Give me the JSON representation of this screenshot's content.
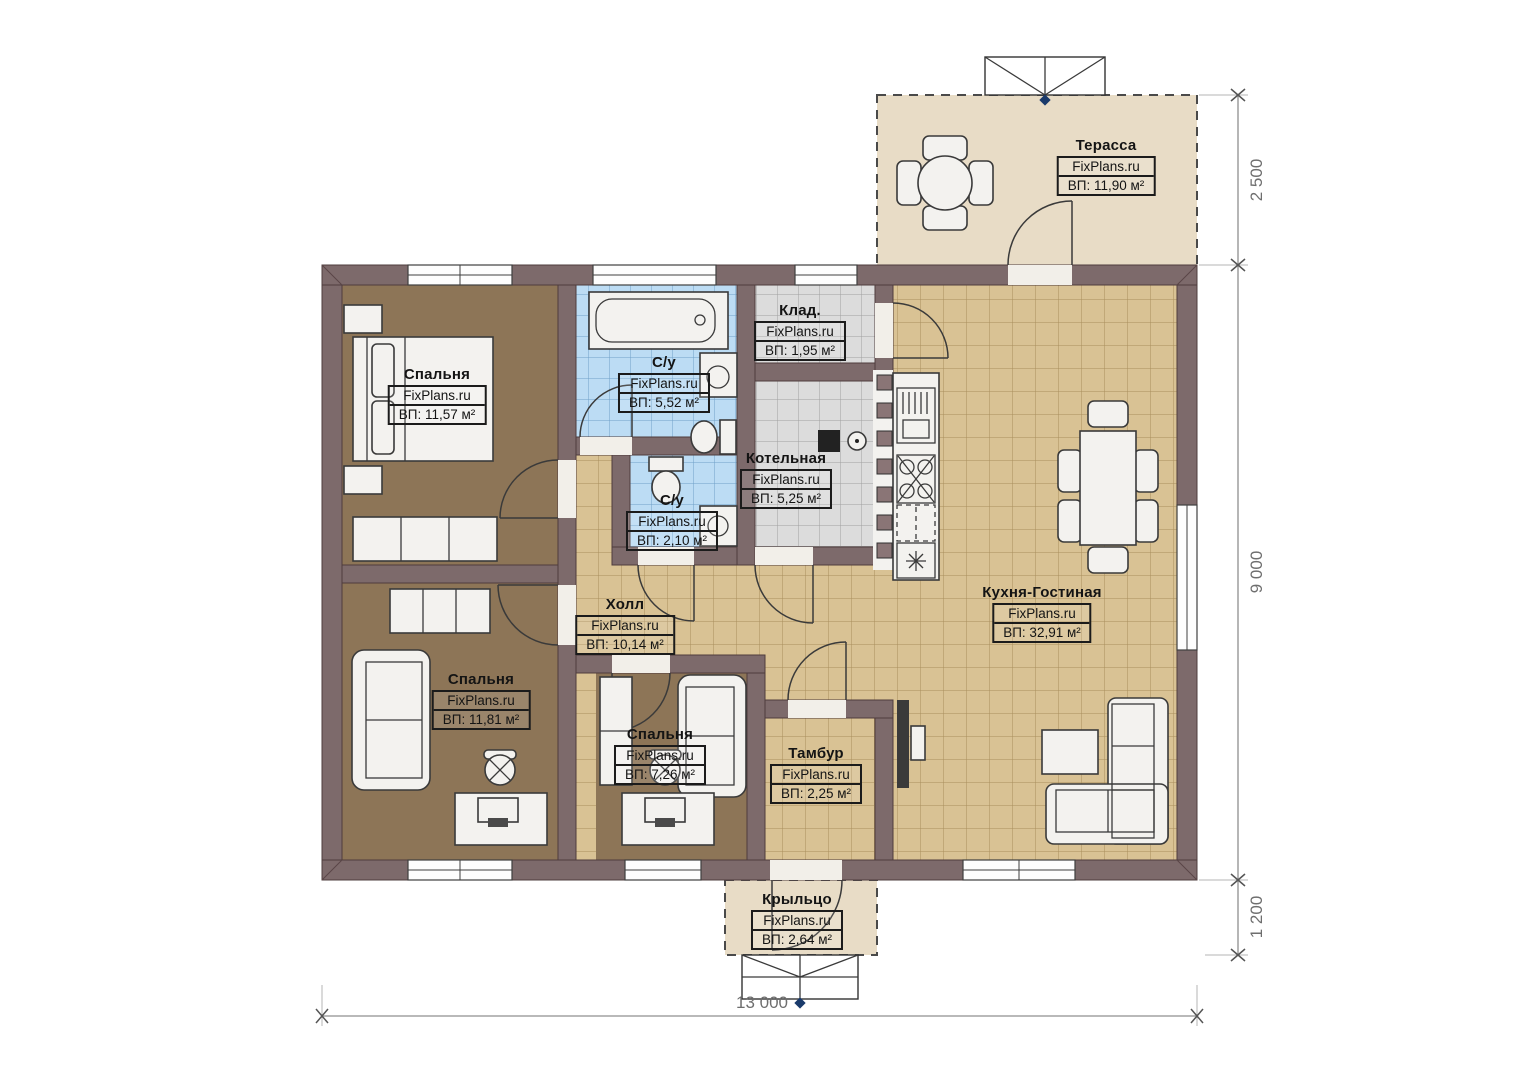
{
  "plan": {
    "brand": "FixPlans.ru",
    "rooms": [
      {
        "key": "terrace",
        "name": "Терасса",
        "watermark": "FixPlans.ru",
        "area": "ВП: 11,90 м²"
      },
      {
        "key": "bedroom-1",
        "name": "Спальня",
        "watermark": "FixPlans.ru",
        "area": "ВП: 11,57 м²"
      },
      {
        "key": "bathroom-main",
        "name": "С/у",
        "watermark": "FixPlans.ru",
        "area": "ВП: 5,52 м²"
      },
      {
        "key": "pantry",
        "name": "Клад.",
        "watermark": "FixPlans.ru",
        "area": "ВП: 1,95 м²"
      },
      {
        "key": "boiler-room",
        "name": "Котельная",
        "watermark": "FixPlans.ru",
        "area": "ВП: 5,25 м²"
      },
      {
        "key": "bathroom-small",
        "name": "С/у",
        "watermark": "FixPlans.ru",
        "area": "ВП: 2,10 м²"
      },
      {
        "key": "hall",
        "name": "Холл",
        "watermark": "FixPlans.ru",
        "area": "ВП: 10,14 м²"
      },
      {
        "key": "kitchen-living",
        "name": "Кухня-Гостиная",
        "watermark": "FixPlans.ru",
        "area": "ВП: 32,91 м²"
      },
      {
        "key": "bedroom-2",
        "name": "Спальня",
        "watermark": "FixPlans.ru",
        "area": "ВП: 11,81 м²"
      },
      {
        "key": "bedroom-3",
        "name": "Спальня",
        "watermark": "FixPlans.ru",
        "area": "ВП: 7,26 м²"
      },
      {
        "key": "vestibule",
        "name": "Тамбур",
        "watermark": "FixPlans.ru",
        "area": "ВП: 2,25 м²"
      },
      {
        "key": "porch",
        "name": "Крыльцо",
        "watermark": "FixPlans.ru",
        "area": "ВП: 2,64 м²"
      }
    ],
    "dimensions": {
      "terrace_depth": "2 500",
      "house_depth": "9 000",
      "porch_depth": "1 200",
      "house_width": "13 000"
    },
    "colors": {
      "wall": "#7d6a6b",
      "bedroom_floor": "#8d7557",
      "tile_beige": "#d9c294",
      "tile_blue": "#bcdcf4",
      "tile_gray": "#dcdcdc",
      "outdoor": "#e8dcc6"
    }
  }
}
